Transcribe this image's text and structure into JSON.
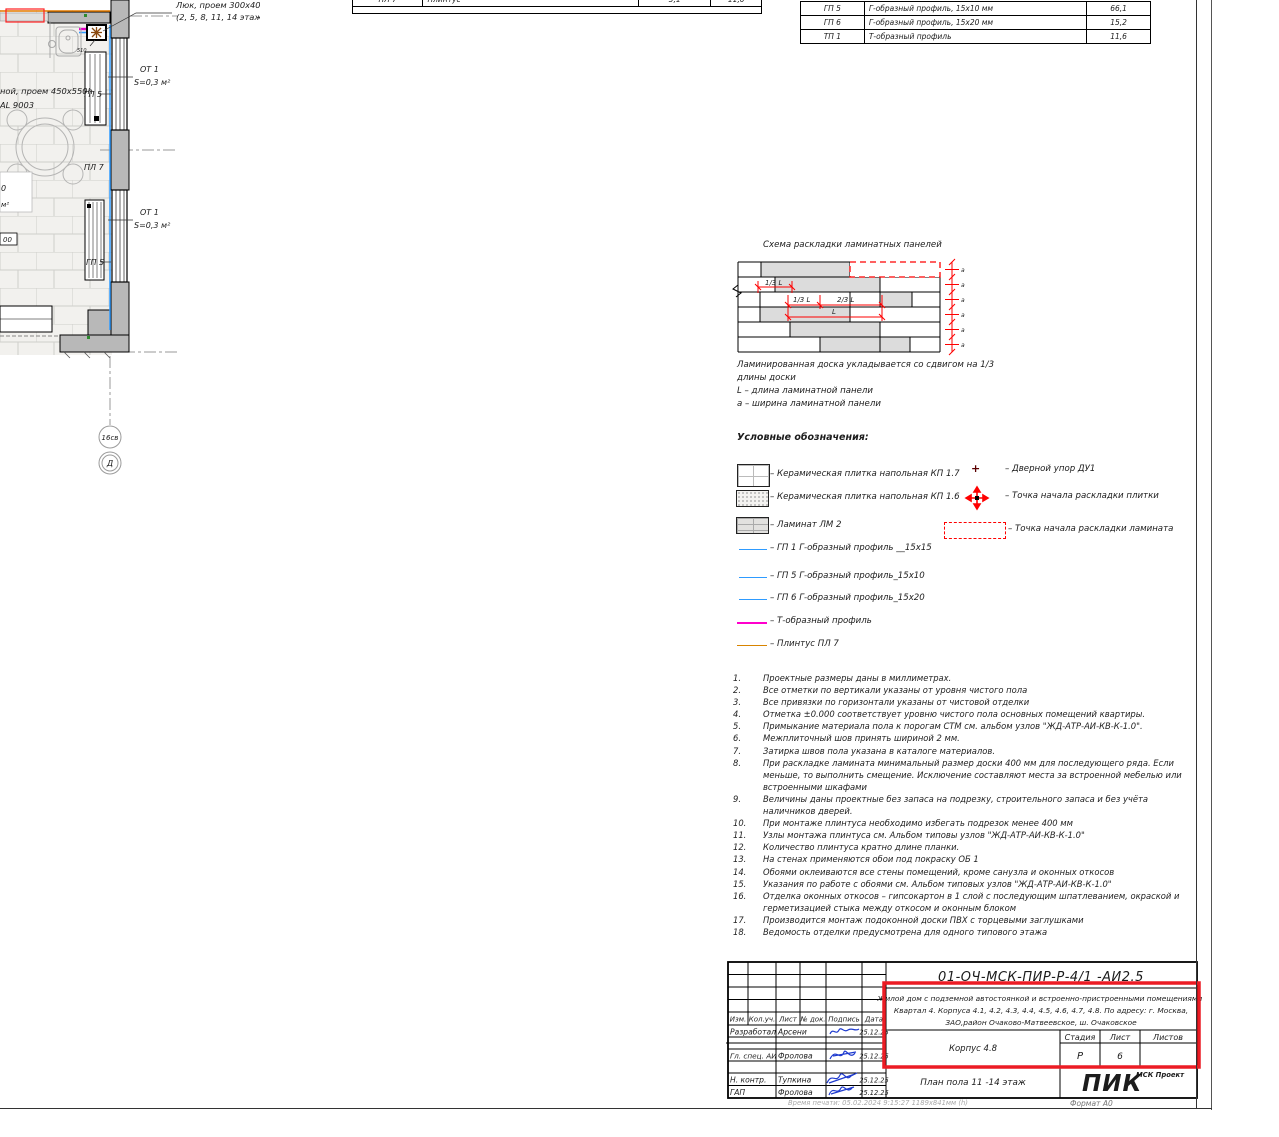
{
  "sheet": {
    "print_info": "Время печати: 05.02.2024  9:15:27      1189х841мм (h)",
    "format_label": "Формат А0"
  },
  "colors": {
    "highlight_red": "#ec1c24",
    "pik_orange": "#fb4f14",
    "profile_blue": "#2e9bff",
    "t_profile_magenta": "#ff00cc",
    "skirting_orange": "#d88400"
  },
  "plan": {
    "callout1": "Люк, проем 300х400 мм, цвет  RAL9003,",
    "callout2": "(2, 5, 8, 11, 14 этаж)",
    "left1": "ной, проем 450х550h",
    "left2": "АL 9003",
    "ot1a_label": "ОТ 1",
    "ot1a_area": "S=0,3 м²",
    "ot1b_label": "ОТ 1",
    "ot1b_area": "S=0,3 м²",
    "gp5_top": "ГП 5",
    "gp5_bot": "ГП 5",
    "pl7": "ПЛ 7",
    "dim510": "510",
    "frag0": "0",
    "fragm2": "м²",
    "frag00": "00",
    "axis1": "16св",
    "axis2": "Д"
  },
  "tt": {
    "code": "ПЛ 7",
    "desc": "Плинтус",
    "v1": "5,1",
    "v2": "11,0"
  },
  "pt": {
    "rows": [
      {
        "code": "ГП 5",
        "desc": "Г-образный профиль,  15х10 мм",
        "value": "66,1"
      },
      {
        "code": "ГП 6",
        "desc": "Г-образный профиль,  15х20 мм",
        "value": "15,2"
      },
      {
        "code": "ТП 1",
        "desc": "Т-образный профиль",
        "value": "11,6"
      }
    ]
  },
  "scheme": {
    "title": "Схема раскладки ламинатных панелей",
    "d13a": "1/3 L",
    "d13b": "1/3 L",
    "d23": "2/3 L",
    "dl": "L",
    "da": "a",
    "c1": "Ламинированная доска укладывается со сдвигом на 1/3",
    "c2": "длины доски",
    "c3": "L – длина ламинатной панели",
    "c4": "а – ширина ламинатной панели"
  },
  "legend": {
    "title": "Условные обозначения:",
    "items": [
      "– Керамическая плитка напольная КП 1.7",
      "– Керамическая плитка напольная КП 1.6",
      "– Ламинат ЛМ 2",
      "– ГП 1 Г-образный профиль __15х15",
      "– ГП 5 Г-образный профиль_15х10",
      "– ГП 6 Г-образный профиль_15х20",
      "– Т-образный профиль",
      "– Плинтус ПЛ 7"
    ],
    "right": [
      "– Дверной упор ДУ1",
      "– Точка начала раскладки плитки",
      "– Точка начала раскладки ламината"
    ]
  },
  "notes": [
    {
      "n": "1.",
      "t": "Проектные размеры даны в миллиметрах."
    },
    {
      "n": "2.",
      "t": "Все отметки по вертикали указаны от уровня чистого пола"
    },
    {
      "n": "3.",
      "t": "Все привязки по горизонтали указаны от чистовой отделки"
    },
    {
      "n": "4.",
      "t": "Отметка ±0.000 соответствует уровню чистого пола основных помещений квартиры."
    },
    {
      "n": "5.",
      "t": "Примыкание материала пола к порогам СТМ см. альбом узлов \"ЖД-АТР-АИ-КВ-К-1.0\"."
    },
    {
      "n": "6.",
      "t": "Межплиточный шов принять шириной 2 мм."
    },
    {
      "n": "7.",
      "t": "Затирка швов пола указана в каталоге материалов."
    },
    {
      "n": "8.",
      "t": "При раскладке ламината минимальный размер доски 400 мм для последующего ряда. Если меньше, то выполнить смещение. Исключение составляют места за встроенной мебелью или встроенными шкафами"
    },
    {
      "n": "9.",
      "t": "Величины даны проектные без запаса на подрезку, строительного запаса и без  учёта наличников дверей."
    },
    {
      "n": "10.",
      "t": "При монтаже плинтуса необходимо избегать подрезок менее 400 мм"
    },
    {
      "n": "11.",
      "t": "Узлы монтажа плинтуса см. Альбом типовы узлов \"ЖД-АТР-АИ-КВ-К-1.0\""
    },
    {
      "n": "12.",
      "t": "Количество плинтуса кратно длине планки."
    },
    {
      "n": "13.",
      "t": "На стенах применяются обои под покраску ОБ 1"
    },
    {
      "n": "14.",
      "t": "Обоями оклеиваются все стены помещений, кроме санузла и оконных откосов"
    },
    {
      "n": "15.",
      "t": "Указания по работе с обоями см. Альбом типовых узлов \"ЖД-АТР-АИ-КВ-К-1.0\""
    },
    {
      "n": "16.",
      "t": "Отделка оконных откосов – гипсокартон в 1 слой с последующим шпатлеванием,  окраской и герметизацией стыка между откосом и оконным блоком"
    },
    {
      "n": "17.",
      "t": "Производится монтаж подоконной доски ПВХ с торцевыми заглушками"
    },
    {
      "n": "18.",
      "t": "Ведомость отделки предусмотрена для одного типового этажа"
    }
  ],
  "tb": {
    "doc_number": "01-ОЧ-МСК-ПИР-Р-4/1 -АИ2.5",
    "project_line1": "Жилой дом с подземной автостоянкой и встроенно-пристроенными помещениями.",
    "project_line2": "Квартал 4. Корпуса 4.1, 4.2, 4.3, 4.4, 4.5, 4.6, 4.7, 4.8. По адресу: г. Москва,",
    "project_line3": "ЗАО,район Очаково-Матвеевское, ш. Очаковское",
    "col_izm": "Изм.",
    "col_koluch": "Кол.уч.",
    "col_list": "Лист",
    "col_dok": "№ док.",
    "col_podpis": "Подпись",
    "col_data": "Дата",
    "rows": [
      {
        "role": "Разработал",
        "name": "Арсени",
        "date": "25.12.25"
      },
      {
        "role": "",
        "name": "",
        "date": ""
      },
      {
        "role": "Гл. спец. АИ",
        "name": "Фролова",
        "date": "25.12.25"
      },
      {
        "role": "",
        "name": "",
        "date": ""
      },
      {
        "role": "Н. контр.",
        "name": "Тупкина",
        "date": "25.12.25"
      },
      {
        "role": "ГАП",
        "name": "Фролова",
        "date": "25.12.25"
      }
    ],
    "korpus": "Корпус 4.8",
    "sheet_title": "План пола 11 -14 этаж",
    "stage_label": "Стадия",
    "stage_value": "Р",
    "list_label": "Лист",
    "list_value": "6",
    "listov_label": "Листов",
    "listov_value": "",
    "logo_text": "ПИК",
    "logo_sub": "МСК Проект"
  }
}
